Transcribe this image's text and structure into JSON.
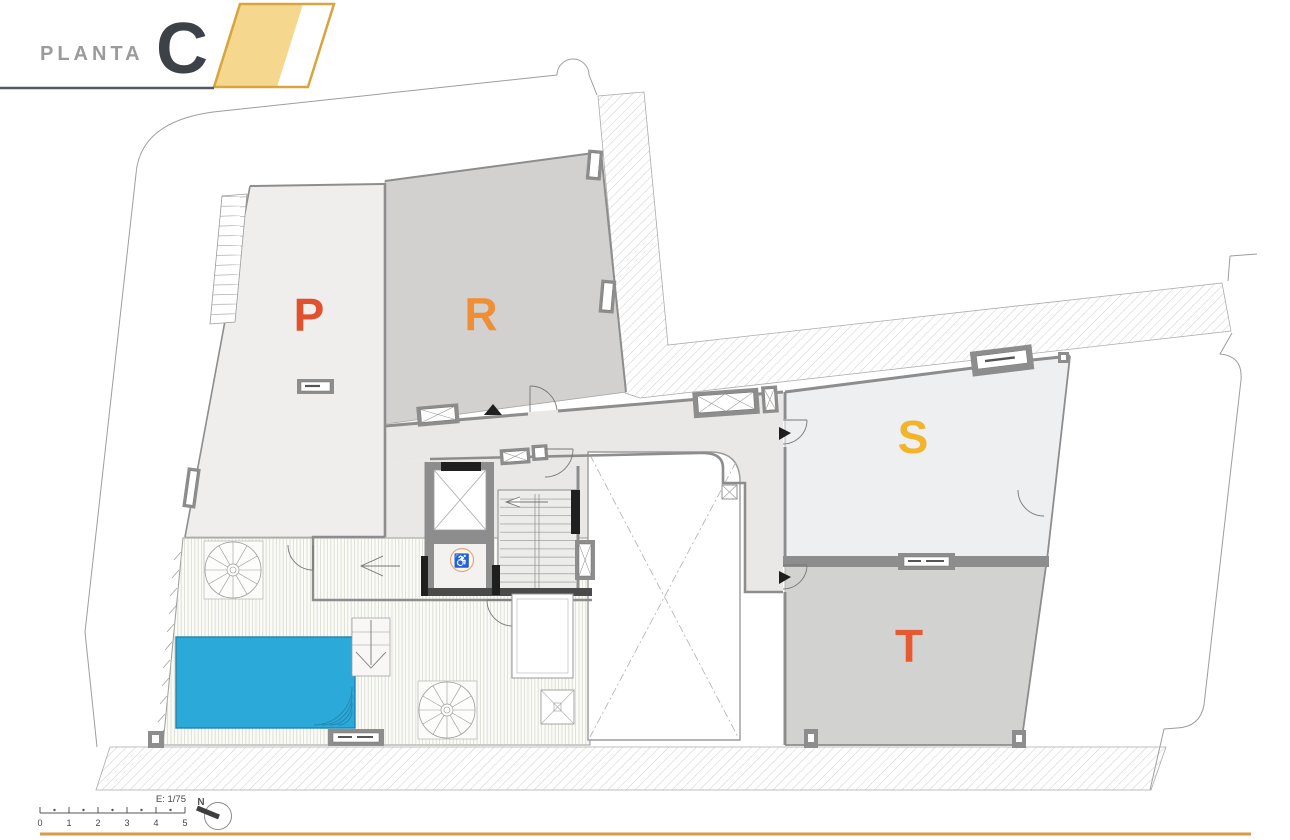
{
  "header": {
    "title": "PLANTA",
    "floor_letter": "C"
  },
  "units": [
    {
      "label": "P",
      "color": "#df512f",
      "fill": "#f0eeec"
    },
    {
      "label": "R",
      "color": "#ef8f35",
      "fill": "#d2d1cf"
    },
    {
      "label": "S",
      "color": "#f1b42a",
      "fill": "#edeff1"
    },
    {
      "label": "T",
      "color": "#e75a31",
      "fill": "#d2d2d0"
    }
  ],
  "legend": {
    "scale_label": "E: 1/75",
    "north_label": "N",
    "scale_ticks": [
      "0",
      "1",
      "2",
      "3",
      "4",
      "5"
    ]
  },
  "icons": {
    "accessibility_symbol": "♿"
  },
  "colors": {
    "accent_yellow_fill": "#f6d78e",
    "accent_yellow_border": "#d8a43d",
    "header_letter": "#3c4247",
    "header_title": "#9b9b9b",
    "underline_dark": "#55585c",
    "underline_orange": "#d79a45",
    "pool": "#2ba9d9",
    "pool_border": "#1e84b1",
    "corridor_fill": "#e9e8e6",
    "wall_gray": "#8d8d8d"
  }
}
